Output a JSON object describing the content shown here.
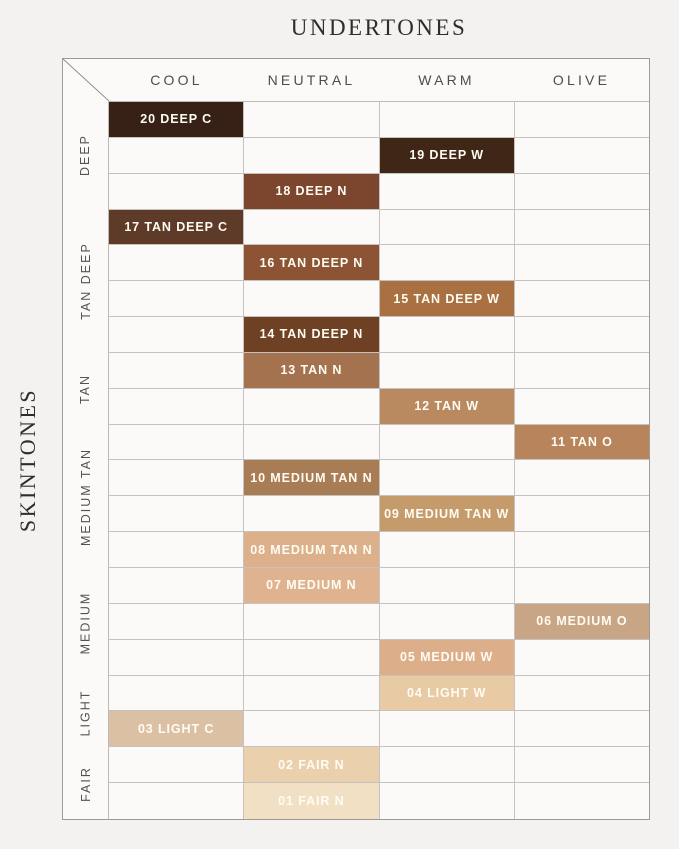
{
  "title": "UNDERTONES",
  "side_title": "SKINTONES",
  "colors": {
    "page_bg": "#F4F2F0",
    "cell_bg": "#FBFAF9",
    "grid_line": "#C6C2BD",
    "outer_border": "#9E9A96",
    "header_text": "#504D49",
    "title_text": "#2F2C29",
    "swatch_label": "#FFFCF3"
  },
  "chart_data": {
    "type": "table",
    "title": "UNDERTONES",
    "columns_axis_label": "UNDERTONES",
    "rows_axis_label": "SKINTONES",
    "columns": [
      "COOL",
      "NEUTRAL",
      "WARM",
      "OLIVE"
    ],
    "row_groups": [
      {
        "label": "DEEP",
        "start_row": 1,
        "row_span": 3
      },
      {
        "label": "TAN DEEP",
        "start_row": 4,
        "row_span": 4
      },
      {
        "label": "TAN",
        "start_row": 8,
        "row_span": 2
      },
      {
        "label": "MEDIUM TAN",
        "start_row": 10,
        "row_span": 4
      },
      {
        "label": "MEDIUM",
        "start_row": 14,
        "row_span": 3
      },
      {
        "label": "LIGHT",
        "start_row": 17,
        "row_span": 2
      },
      {
        "label": "FAIR",
        "start_row": 19,
        "row_span": 2
      }
    ],
    "cells": [
      {
        "row": 1,
        "group": "DEEP",
        "column": "COOL",
        "shade": "20 DEEP C",
        "color": "#372116"
      },
      {
        "row": 2,
        "group": "DEEP",
        "column": "WARM",
        "shade": "19 DEEP W",
        "color": "#402617"
      },
      {
        "row": 3,
        "group": "DEEP",
        "column": "NEUTRAL",
        "shade": "18 DEEP N",
        "color": "#7C452D"
      },
      {
        "row": 4,
        "group": "TAN DEEP",
        "column": "COOL",
        "shade": "17 TAN DEEP C",
        "color": "#5E3B28"
      },
      {
        "row": 5,
        "group": "TAN DEEP",
        "column": "NEUTRAL",
        "shade": "16 TAN DEEP N",
        "color": "#8C5434"
      },
      {
        "row": 6,
        "group": "TAN DEEP",
        "column": "WARM",
        "shade": "15 TAN DEEP W",
        "color": "#A97141"
      },
      {
        "row": 7,
        "group": "TAN DEEP",
        "column": "NEUTRAL",
        "shade": "14 TAN DEEP N",
        "color": "#6E4124"
      },
      {
        "row": 8,
        "group": "TAN",
        "column": "NEUTRAL",
        "shade": "13 TAN N",
        "color": "#A4724E"
      },
      {
        "row": 9,
        "group": "TAN",
        "column": "WARM",
        "shade": "12 TAN W",
        "color": "#B9895F"
      },
      {
        "row": 10,
        "group": "MEDIUM TAN",
        "column": "OLIVE",
        "shade": "11 TAN O",
        "color": "#B8845C"
      },
      {
        "row": 11,
        "group": "MEDIUM TAN",
        "column": "NEUTRAL",
        "shade": "10 MEDIUM TAN N",
        "color": "#A87D55"
      },
      {
        "row": 12,
        "group": "MEDIUM TAN",
        "column": "WARM",
        "shade": "09 MEDIUM TAN W",
        "color": "#C59B6B"
      },
      {
        "row": 13,
        "group": "MEDIUM TAN",
        "column": "NEUTRAL",
        "shade": "08 MEDIUM TAN N",
        "color": "#DBB08B"
      },
      {
        "row": 14,
        "group": "MEDIUM",
        "column": "NEUTRAL",
        "shade": "07 MEDIUM N",
        "color": "#DFB390"
      },
      {
        "row": 15,
        "group": "MEDIUM",
        "column": "OLIVE",
        "shade": "06 MEDIUM O",
        "color": "#C8A685"
      },
      {
        "row": 16,
        "group": "MEDIUM",
        "column": "WARM",
        "shade": "05 MEDIUM W",
        "color": "#DCAE8A"
      },
      {
        "row": 17,
        "group": "LIGHT",
        "column": "WARM",
        "shade": "04 LIGHT W",
        "color": "#E8CAA5"
      },
      {
        "row": 18,
        "group": "LIGHT",
        "column": "COOL",
        "shade": "03 LIGHT C",
        "color": "#DCC0A3"
      },
      {
        "row": 19,
        "group": "FAIR",
        "column": "NEUTRAL",
        "shade": "02 FAIR N",
        "color": "#EBD0AD"
      },
      {
        "row": 20,
        "group": "FAIR",
        "column": "NEUTRAL",
        "shade": "01 FAIR N",
        "color": "#F2E0C4"
      }
    ]
  }
}
